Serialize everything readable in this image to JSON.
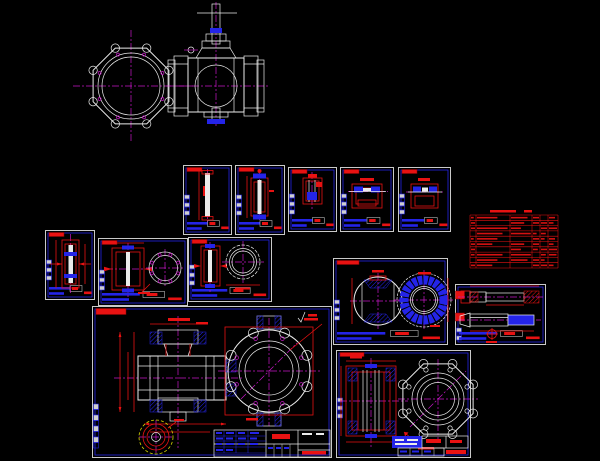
{
  "canvas": {
    "width": 600,
    "height": 461,
    "background": "#000000"
  },
  "palette": {
    "background": "#000000",
    "line_white": "#ebebeb",
    "border_white": "#c9c9c9",
    "cad_blue": "#2424e8",
    "dim_red": "#e81212",
    "dark_red": "#8c0202",
    "magenta": "#c617c6",
    "yellow": "#d6d600"
  },
  "sheets": [
    {
      "name": "pin",
      "x": 183,
      "y": 165,
      "w": 49,
      "h": 70,
      "miniY": 30
    },
    {
      "name": "stem-small",
      "x": 235,
      "y": 165,
      "w": 50,
      "h": 70,
      "miniY": 30
    },
    {
      "name": "gland",
      "x": 288,
      "y": 167,
      "w": 49,
      "h": 65,
      "miniY": 27
    },
    {
      "name": "seat-a",
      "x": 340,
      "y": 167,
      "w": 54,
      "h": 65,
      "miniY": 27
    },
    {
      "name": "seat-b",
      "x": 398,
      "y": 167,
      "w": 53,
      "h": 65,
      "miniY": 27
    },
    {
      "name": "stem-long",
      "x": 45,
      "y": 230,
      "w": 50,
      "h": 70,
      "miniY": 30
    },
    {
      "name": "packing",
      "x": 98,
      "y": 238,
      "w": 90,
      "h": 68,
      "miniY": 32
    },
    {
      "name": "seat-ring",
      "x": 188,
      "y": 237,
      "w": 84,
      "h": 65,
      "miniY": 28
    },
    {
      "name": "body",
      "x": 92,
      "y": 306,
      "w": 240,
      "h": 152,
      "miniY": 98,
      "miniCount": 8,
      "chipW": 30,
      "chipH": 6,
      "tb": "custom"
    },
    {
      "name": "ball",
      "x": 333,
      "y": 258,
      "w": 115,
      "h": 87,
      "miniY": 42,
      "chipW": 22
    },
    {
      "name": "stems",
      "x": 455,
      "y": 284,
      "w": 91,
      "h": 61,
      "miniY": 44,
      "miniCount": 3,
      "chips": "double-left"
    },
    {
      "name": "bonnet",
      "x": 336,
      "y": 350,
      "w": 135,
      "h": 108,
      "miniY": 48,
      "chipW": 24,
      "tb": "custom"
    }
  ],
  "bom_table": {
    "x": 470,
    "y": 209,
    "w": 88,
    "h": 59,
    "rows": 10,
    "header_h": 6,
    "cols": [
      0,
      6,
      40,
      62,
      70,
      78,
      88
    ],
    "title_bars": [
      [
        20,
        26
      ],
      [
        54,
        8
      ]
    ]
  }
}
